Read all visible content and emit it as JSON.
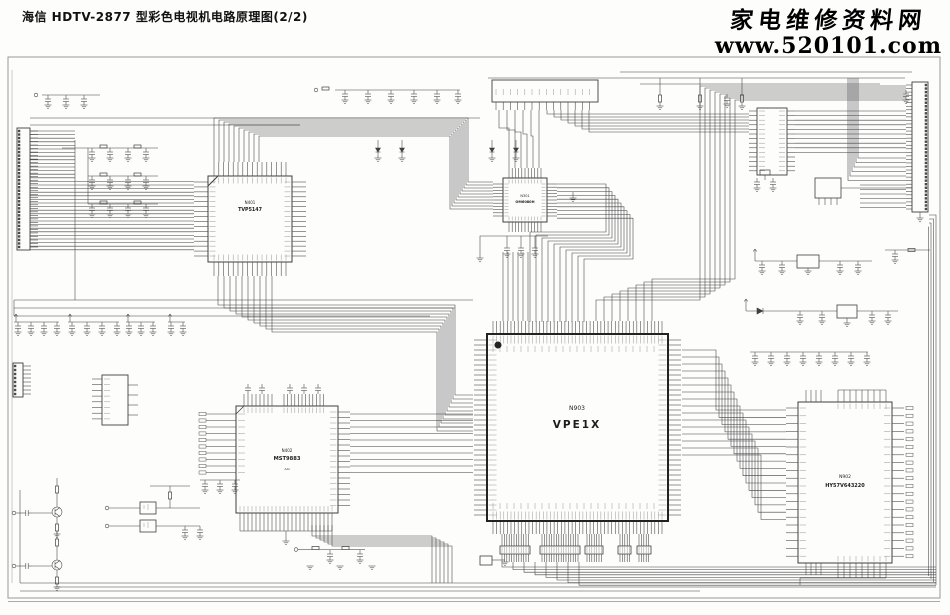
{
  "header": {
    "title": "海信 HDTV-2877 型彩色电视机电路原理图(2/2)",
    "site_name": "家电维修资料网",
    "site_url": "www.520101.com"
  },
  "chips": {
    "n401": {
      "ref": "N401",
      "part": "TVP5147"
    },
    "n301": {
      "ref": "N301",
      "part": "OM6080H"
    },
    "n903": {
      "ref": "N903",
      "part": "VPE1X"
    },
    "n402": {
      "ref": "N402",
      "part": "MST9883",
      "sub": "AAI"
    },
    "n902": {
      "ref": "N902",
      "part": "HY57V643220"
    }
  },
  "colors": {
    "ink": "#3f3f3f",
    "frame": "#999999",
    "paper": "#fdfdfc"
  }
}
